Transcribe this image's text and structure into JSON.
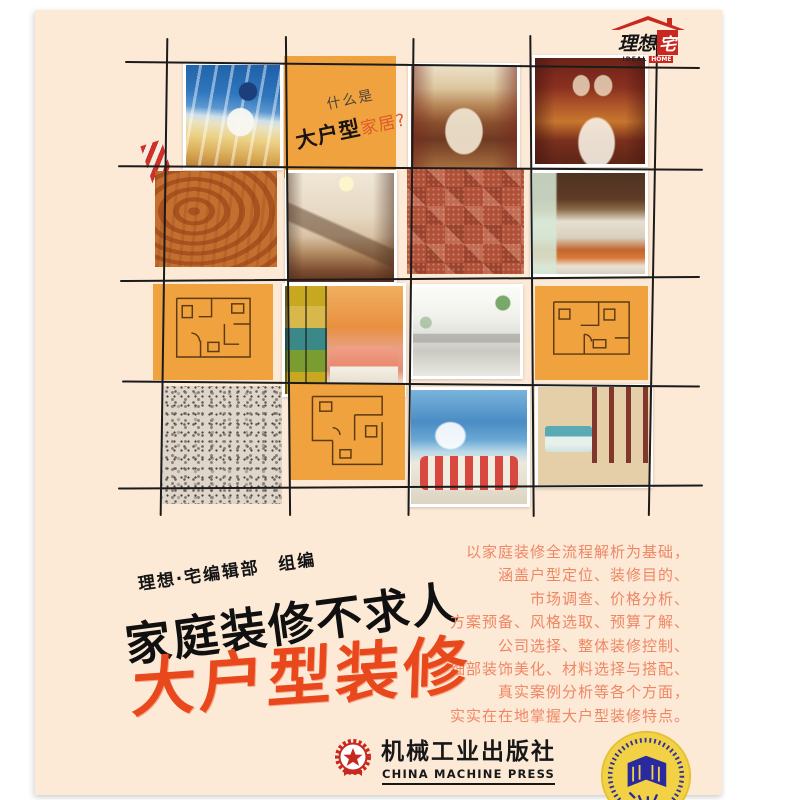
{
  "cover": {
    "brand": {
      "name_prefix": "理想",
      "name_suffix": "宅",
      "tagline_left": "IDEAL",
      "tagline_right": "HOME"
    },
    "question_tile": {
      "line1": "什么是",
      "line2_bold": "大户型",
      "line2_tail": "家居?"
    },
    "author_credit": "理想·宅编辑部　组编",
    "series_title": "家庭装修不求人",
    "main_title": "大户型装修",
    "blurb": [
      "以家庭装修全流程解析为基础，",
      "涵盖户型定位、装修目的、",
      "市场调查、价格分析、",
      "方案预备、风格选取、预算了解、",
      "公司选择、整体装修控制、",
      "细部装饰美化、材料选择与搭配、",
      "真实案例分析等各个方面，",
      "实实在在地掌握大户型装修特点。"
    ],
    "publisher": {
      "name_cn": "机械工业出版社",
      "name_en": "CHINA MACHINE PRESS"
    }
  },
  "colors": {
    "cover_bg": "#fce9d6",
    "title_red": "#e8481c",
    "blurb_salmon": "#ee8765",
    "tile_orange": "#f0a23e",
    "brand_red": "#c8281e"
  }
}
